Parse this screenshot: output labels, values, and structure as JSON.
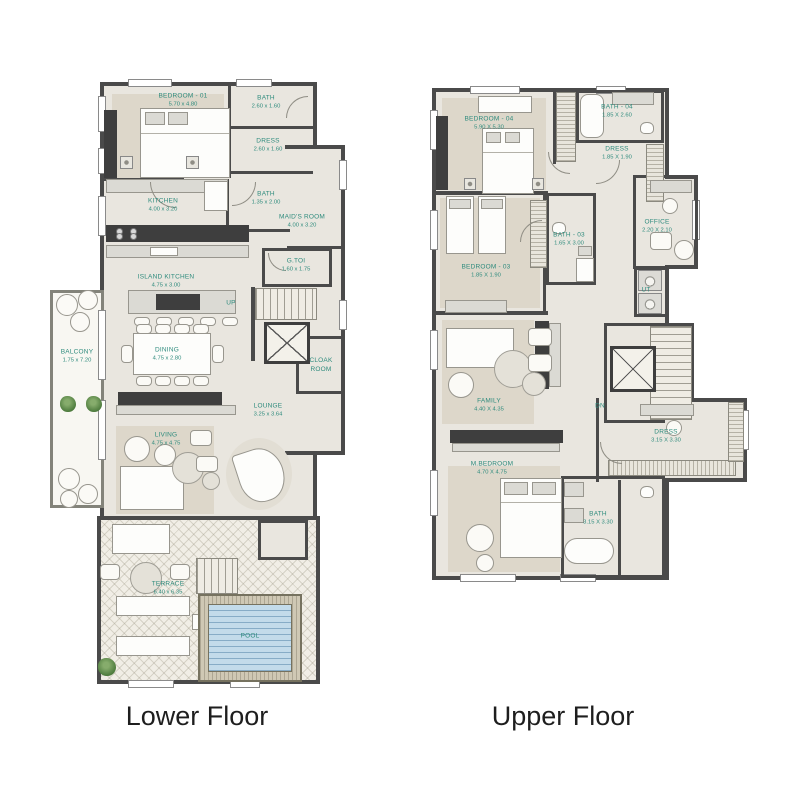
{
  "captions": {
    "lower": "Lower Floor",
    "upper": "Upper Floor"
  },
  "colors": {
    "wall": "#4a4a4a",
    "floor": "#e9e6df",
    "rug": "#ddd7ca",
    "label_teal": "#2e8b7d",
    "pool_water": "#c3dbea",
    "caption_text": "#1e1e1e"
  },
  "lower_floor": {
    "rooms": {
      "bedroom01": {
        "name": "BEDROOM - 01",
        "dims": "5.70 x 4.80"
      },
      "bath_01": {
        "name": "BATH",
        "dims": "2.60 x 1.60"
      },
      "dress": {
        "name": "DRESS",
        "dims": "2.60 x 1.60"
      },
      "kitchen": {
        "name": "KITCHEN",
        "dims": "4.00 x 3.20"
      },
      "bath_02": {
        "name": "BATH",
        "dims": "1.35 x 2.00"
      },
      "maids_room": {
        "name": "MAID'S ROOM",
        "dims": "4.00 x 3.20"
      },
      "g_toi": {
        "name": "G.TOI",
        "dims": "1.60 x 1.75"
      },
      "island_kitchen": {
        "name": "ISLAND KITCHEN",
        "dims": "4.75 x 3.00"
      },
      "dining": {
        "name": "DINING",
        "dims": "4.75 x 2.80"
      },
      "lounge": {
        "name": "LOUNGE",
        "dims": "3.25 x 3.64"
      },
      "living": {
        "name": "LIVING",
        "dims": "4.75 x 4.75"
      },
      "cloak_room": {
        "name": "CLOAK ROOM",
        "dims": ""
      },
      "balcony": {
        "name": "BALCONY",
        "dims": "1.75 x 7.20"
      },
      "terrace": {
        "name": "TERRACE",
        "dims": "6.40 x 6.35"
      },
      "pool": {
        "name": "POOL",
        "dims": ""
      },
      "stairs_up": {
        "name": "UP",
        "dims": ""
      }
    }
  },
  "upper_floor": {
    "rooms": {
      "bedroom04": {
        "name": "BEDROOM - 04",
        "dims": "5.90 X 5.30"
      },
      "bath_04": {
        "name": "BATH - 04",
        "dims": "1.85 X 2.60"
      },
      "dress_04": {
        "name": "DRESS",
        "dims": "1.85 X 1.90"
      },
      "bedroom03": {
        "name": "BEDROOM - 03",
        "dims": "1.85 X 1.90"
      },
      "bath_03": {
        "name": "BATH - 03",
        "dims": "1.65 X 3.00"
      },
      "office": {
        "name": "OFFICE",
        "dims": "2.20 X 2.10"
      },
      "utility": {
        "name": "UT",
        "dims": ""
      },
      "family": {
        "name": "FAMILY",
        "dims": "4.40 X 4.35"
      },
      "dress_master": {
        "name": "DRESS",
        "dims": "3.15 X 3.30"
      },
      "master_bedroom": {
        "name": "M.BEDROOM",
        "dims": "4.70 X 4.75"
      },
      "bath_master": {
        "name": "BATH",
        "dims": "3.15 X 3.30"
      },
      "stairs_dn": {
        "name": "DN",
        "dims": ""
      }
    }
  }
}
